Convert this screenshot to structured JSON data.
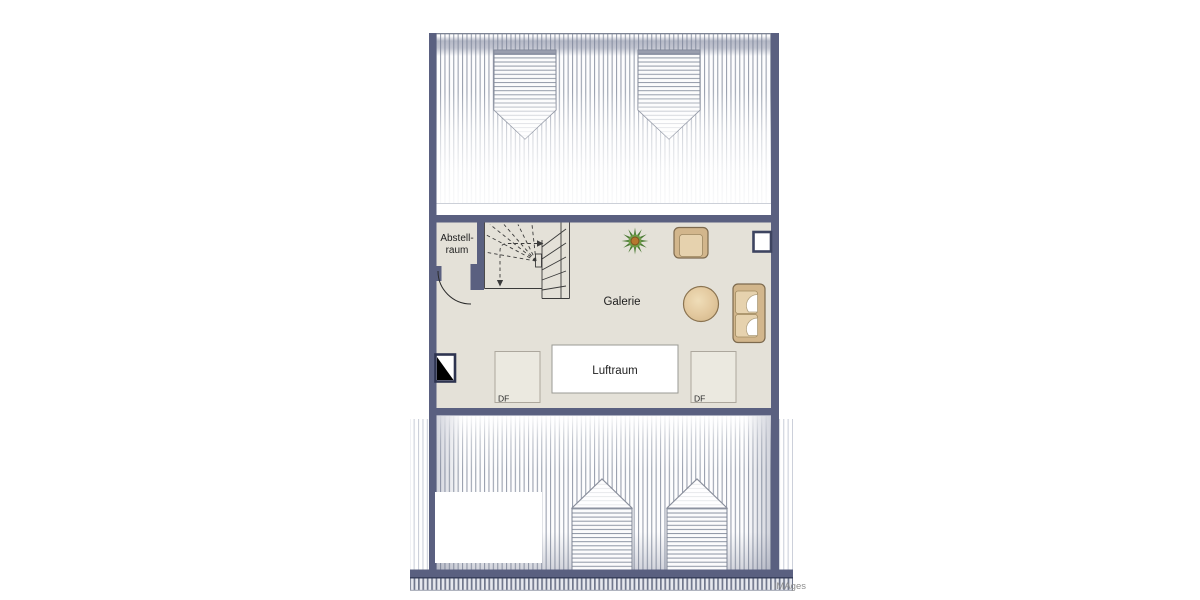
{
  "plan": {
    "title": "attic-floor-plan",
    "rooms": [
      {
        "id": "abstellraum",
        "label_line1": "Abstell-",
        "label_line2": "raum"
      },
      {
        "id": "galerie",
        "label": "Galerie"
      },
      {
        "id": "luftraum",
        "label": "Luftraum"
      }
    ],
    "roof_windows": [
      {
        "label": "DF"
      },
      {
        "label": "DF"
      }
    ],
    "watermark": "IMAges",
    "icons": {
      "stairs": "winder-staircase",
      "door": "door-swing-arc",
      "plant": "potted-plant",
      "armchair": "armchair",
      "table": "round-table",
      "sofa": "two-seat-sofa",
      "chimney": "chimney",
      "window": "wall-window",
      "roof_window": "roof-window-df",
      "dormer": "dormer"
    },
    "colors": {
      "wall": "#5a6080",
      "floor": "#e4e1d8",
      "hatch_line": "#9aa1af",
      "dormer_hatch_line": "#8d95a4",
      "luftraum_fill": "#ffffff",
      "df_fill": "#ebe9e0",
      "furniture_fill": "#d2b68c",
      "furniture_border": "#7d6a4e",
      "cushion_fill": "#e6d2ae",
      "plant_green": "#4a7a33",
      "plant_center": "#b5772f",
      "chimney_dark": "#2e3450",
      "line_dark": "#3a3a3a"
    }
  }
}
